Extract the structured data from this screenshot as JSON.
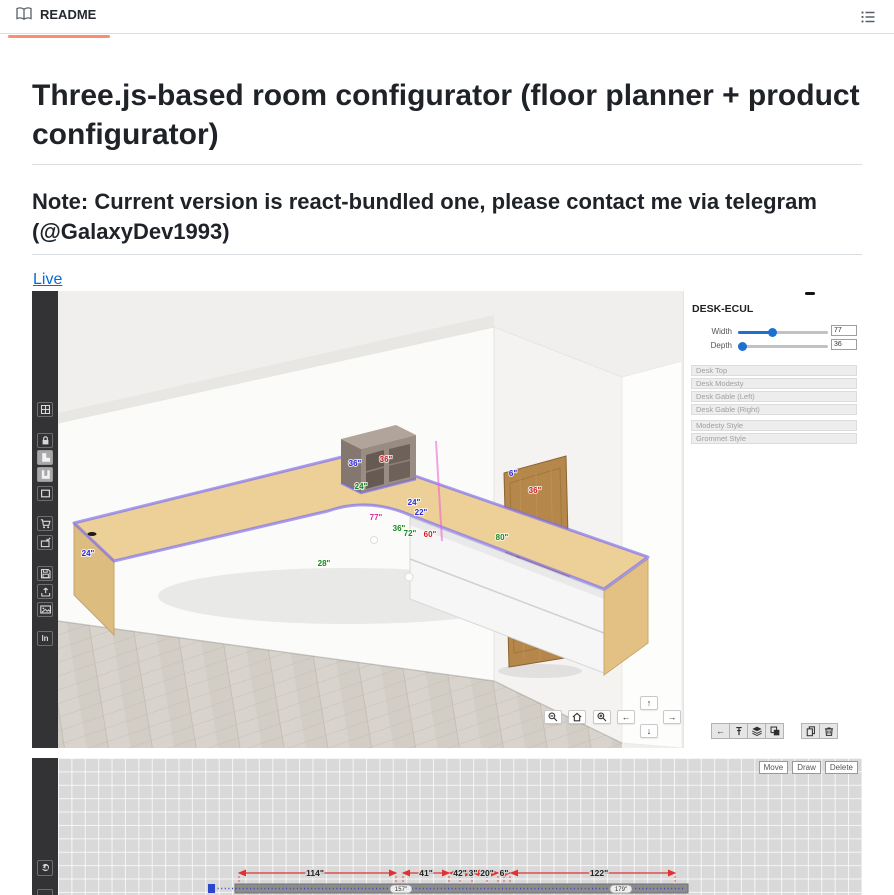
{
  "header": {
    "tab_label": "README"
  },
  "doc": {
    "title": "Three.js-based room configurator (floor planner + product configurator)",
    "note": "Note: Current version is react-bundled one, please contact me via telegram (@GalaxyDev1993)",
    "live_label": "Live"
  },
  "app3d": {
    "sidebar_icons": [
      "grid",
      "lock",
      "l-room-shape",
      "u-room-shape",
      "rect-room-shape",
      "cart",
      "import-model",
      "save",
      "upload",
      "screenshot",
      "ln"
    ],
    "ln_label": "ln",
    "panel": {
      "title": "DESK-ECUL",
      "sliders": [
        {
          "label": "Width",
          "value": "77"
        },
        {
          "label": "Depth",
          "value": "36"
        }
      ],
      "parts": [
        "Desk Top",
        "Desk Modesty",
        "Desk Gable (Left)",
        "Desk Gable (Right)"
      ],
      "styles": [
        "Modesty Style",
        "Grommet Style"
      ]
    },
    "nav_arrows": {
      "left": "←",
      "up": "↑",
      "down": "↓",
      "right": "→"
    },
    "scene": {
      "labels": [
        {
          "text": "36\"",
          "color": "#2b2bdd"
        },
        {
          "text": "36\"",
          "color": "#cc2222"
        },
        {
          "text": "24\"",
          "color": "#17891c"
        },
        {
          "text": "24\"",
          "color": "#2b2bdd"
        },
        {
          "text": "22\"",
          "color": "#2b2bdd"
        },
        {
          "text": "77\"",
          "color": "#d6309a"
        },
        {
          "text": "36\"",
          "color": "#17891c"
        },
        {
          "text": "72\"",
          "color": "#17891c"
        },
        {
          "text": "60\"",
          "color": "#cc2222"
        },
        {
          "text": "24\"",
          "color": "#2b2bdd"
        },
        {
          "text": "28\"",
          "color": "#17891c"
        },
        {
          "text": "6\"",
          "color": "#2b2bdd"
        },
        {
          "text": "36\"",
          "color": "#cc2222"
        },
        {
          "text": "80\"",
          "color": "#17891c"
        }
      ]
    }
  },
  "planner2d": {
    "buttons": [
      "Move",
      "Draw",
      "Delete"
    ],
    "dim_labels": [
      {
        "text": "114\""
      },
      {
        "text": "41\""
      },
      {
        "text": "42\""
      },
      {
        "text": "3\""
      },
      {
        "text": "20\""
      },
      {
        "text": "6\""
      },
      {
        "text": "122\""
      }
    ],
    "wall_labels": [
      {
        "text": "157\""
      },
      {
        "text": "179\""
      }
    ]
  },
  "colors": {
    "accent_orange": "#fd8c73",
    "link_blue": "#0969da",
    "slider_blue": "#1d6fd0",
    "dim_red": "#e03232",
    "sidebar_dark": "#333336"
  }
}
